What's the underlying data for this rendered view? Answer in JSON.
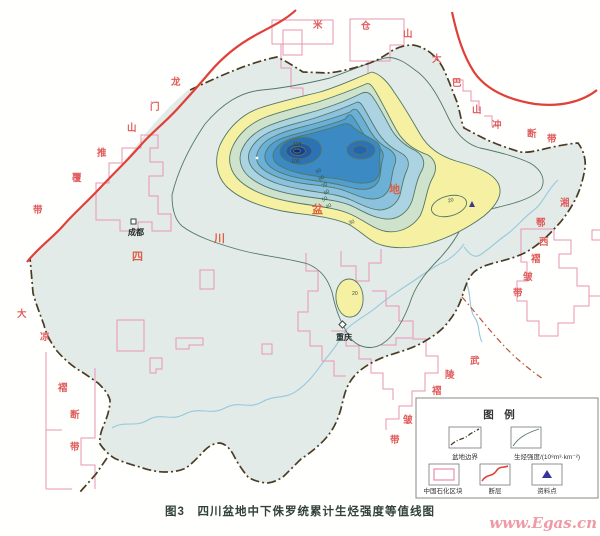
{
  "figure": {
    "caption": "图3　四川盆地中下侏罗统累计生烃强度等值线图",
    "watermark": "www.Egas.cn"
  },
  "legend": {
    "title": "图　例",
    "items": [
      {
        "id": "basin-boundary",
        "label": "盆地边界",
        "symbol": "dash-dot-line"
      },
      {
        "id": "generation-intensity",
        "label": "生烃强度/(10⁸m³·km⁻²)",
        "symbol": "contour-line"
      },
      {
        "id": "sinopec-block",
        "label": "中国石化区块",
        "symbol": "pink-rectangle"
      },
      {
        "id": "fault",
        "label": "断层",
        "symbol": "red-line"
      },
      {
        "id": "data-point",
        "label": "资料点",
        "symbol": "blue-triangle"
      }
    ]
  },
  "cities": [
    {
      "name": "成都"
    },
    {
      "name": "重庆"
    }
  ],
  "basin_name_chars": [
    "四",
    "川",
    "盆",
    "地"
  ],
  "tectonic_labels": {
    "micangshan": {
      "name": "米仓山",
      "chars": [
        "米",
        "仓",
        "山"
      ]
    },
    "longmenshan": {
      "name": "龙门山推覆带",
      "chars": [
        "龙",
        "门",
        "山",
        "推",
        "覆",
        "带"
      ]
    },
    "dabashan": {
      "name": "大巴山冲断带",
      "chars": [
        "大",
        "巴",
        "山",
        "冲",
        "断",
        "带"
      ]
    },
    "xiangexi": {
      "name": "湘鄂西褶皱带",
      "chars": [
        "湘",
        "鄂",
        "西",
        "褶",
        "皱",
        "带"
      ]
    },
    "daliang": {
      "name": "大凉褶断带",
      "chars": [
        "大",
        "凉",
        "褶",
        "断",
        "带"
      ]
    },
    "wuling": {
      "name": "武陵褶皱带",
      "chars": [
        "武",
        "陵",
        "褶",
        "皱",
        "带"
      ]
    }
  },
  "contour_labels": {
    "peak_inner": "110",
    "peak": "100",
    "c90": "90",
    "c80": "80",
    "c70": "70",
    "c60": "60",
    "c50": "50",
    "c40": "40",
    "c30": "30",
    "se_closed": "20",
    "chongqing_closed": "20"
  },
  "chart_data": {
    "type": "contour-map",
    "title": "四川盆地中下侏罗统累计生烃强度等值线图",
    "figure_number": "图3",
    "units": "10⁸m³·km⁻²",
    "quantity": "累计生烃强度",
    "contour_levels": [
      10,
      20,
      30,
      40,
      50,
      60,
      70,
      80,
      90,
      100,
      110
    ],
    "visible_contour_label_values": [
      110,
      100,
      90,
      80,
      70,
      60,
      50,
      40,
      30,
      20
    ],
    "max_label_value": 110,
    "notes": "两个高值中心位于盆地中北部；东南部及重庆附近各有一个20等值线闭合圈"
  },
  "colors": {
    "fault_red": "#e04038",
    "block_pink": "#ea96b4",
    "basin_boundary": "#4a3c24",
    "contour_line": "#527767",
    "yellow_band": "#f5f0a2",
    "basin_fill": "#e2ebe7",
    "blue_center": "#12286f",
    "river_blue": "#96c8de",
    "tectonic_label_red": "#e05c5c",
    "watermark_pink": "#f09aa6"
  }
}
